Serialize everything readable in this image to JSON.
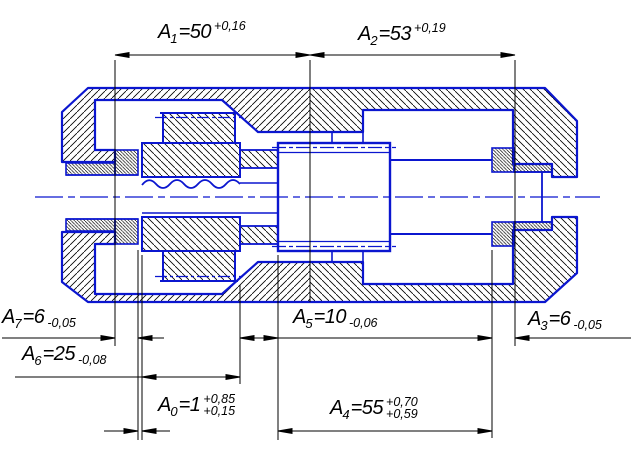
{
  "drawing": {
    "kind": "dimension-chain-assembly-section",
    "colors": {
      "part_outline_blue": "#0b16cf",
      "hatch_black": "#000000",
      "dimension_black": "#000000",
      "background": "#ffffff"
    },
    "dims": {
      "a1": {
        "sym": "A",
        "idx": "1",
        "val": "=50",
        "tol_top": "+0,16",
        "tol_bot": ""
      },
      "a2": {
        "sym": "A",
        "idx": "2",
        "val": "=53",
        "tol_top": "+0,19",
        "tol_bot": ""
      },
      "a7": {
        "sym": "A",
        "idx": "7",
        "val": "=6",
        "tol_top": "",
        "tol_bot": "-0,05"
      },
      "a6": {
        "sym": "A",
        "idx": "6",
        "val": "=25",
        "tol_top": "",
        "tol_bot": "-0,08"
      },
      "a5": {
        "sym": "A",
        "idx": "5",
        "val": "=10",
        "tol_top": "",
        "tol_bot": "-0,06"
      },
      "a3": {
        "sym": "A",
        "idx": "3",
        "val": "=6",
        "tol_top": "",
        "tol_bot": "-0,05"
      },
      "a0": {
        "sym": "A",
        "idx": "0",
        "val": "=1",
        "tol_top": "+0,85",
        "tol_bot": "+0,15"
      },
      "a4": {
        "sym": "A",
        "idx": "4",
        "val": "=55",
        "tol_top": "+0,70",
        "tol_bot": "+0,59"
      }
    }
  }
}
